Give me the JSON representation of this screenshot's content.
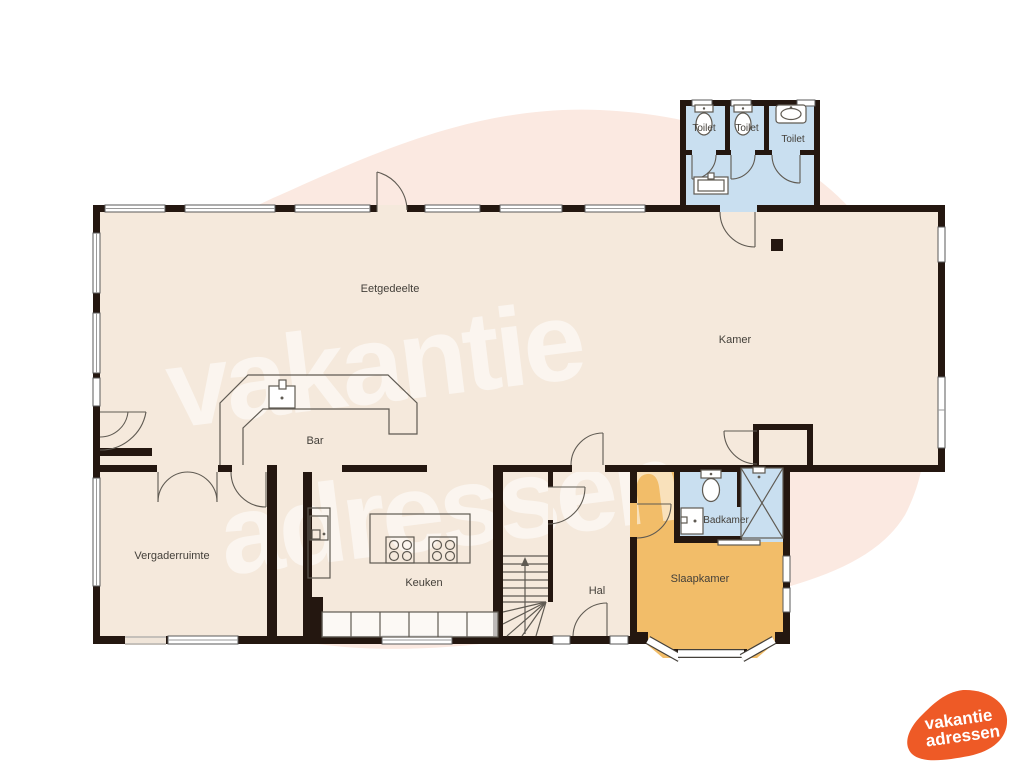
{
  "watermark": {
    "line1": "vakantie",
    "line2": "adressen"
  },
  "logo": {
    "line1": "vakantie",
    "line2": "adressen"
  },
  "rooms": {
    "eetgedeelte": {
      "label": "Eetgedeelte"
    },
    "kamer": {
      "label": "Kamer"
    },
    "bar": {
      "label": "Bar"
    },
    "vergaderruimte": {
      "label": "Vergaderruimte"
    },
    "keuken": {
      "label": "Keuken"
    },
    "hal": {
      "label": "Hal"
    },
    "slaapkamer": {
      "label": "Slaapkamer"
    },
    "badkamer": {
      "label": "Badkamer"
    },
    "toilet1": {
      "label": "Toilet"
    },
    "toilet2": {
      "label": "Toilet"
    },
    "toilet3": {
      "label": "Toilet"
    }
  },
  "colors": {
    "wall": "#241710",
    "floor": "#f5e9dc",
    "bedroom": "#f2bd69",
    "sanitary": "#c9dff0",
    "background_blob": "#fbe9e1",
    "logo_orange": "#ee5a26"
  }
}
